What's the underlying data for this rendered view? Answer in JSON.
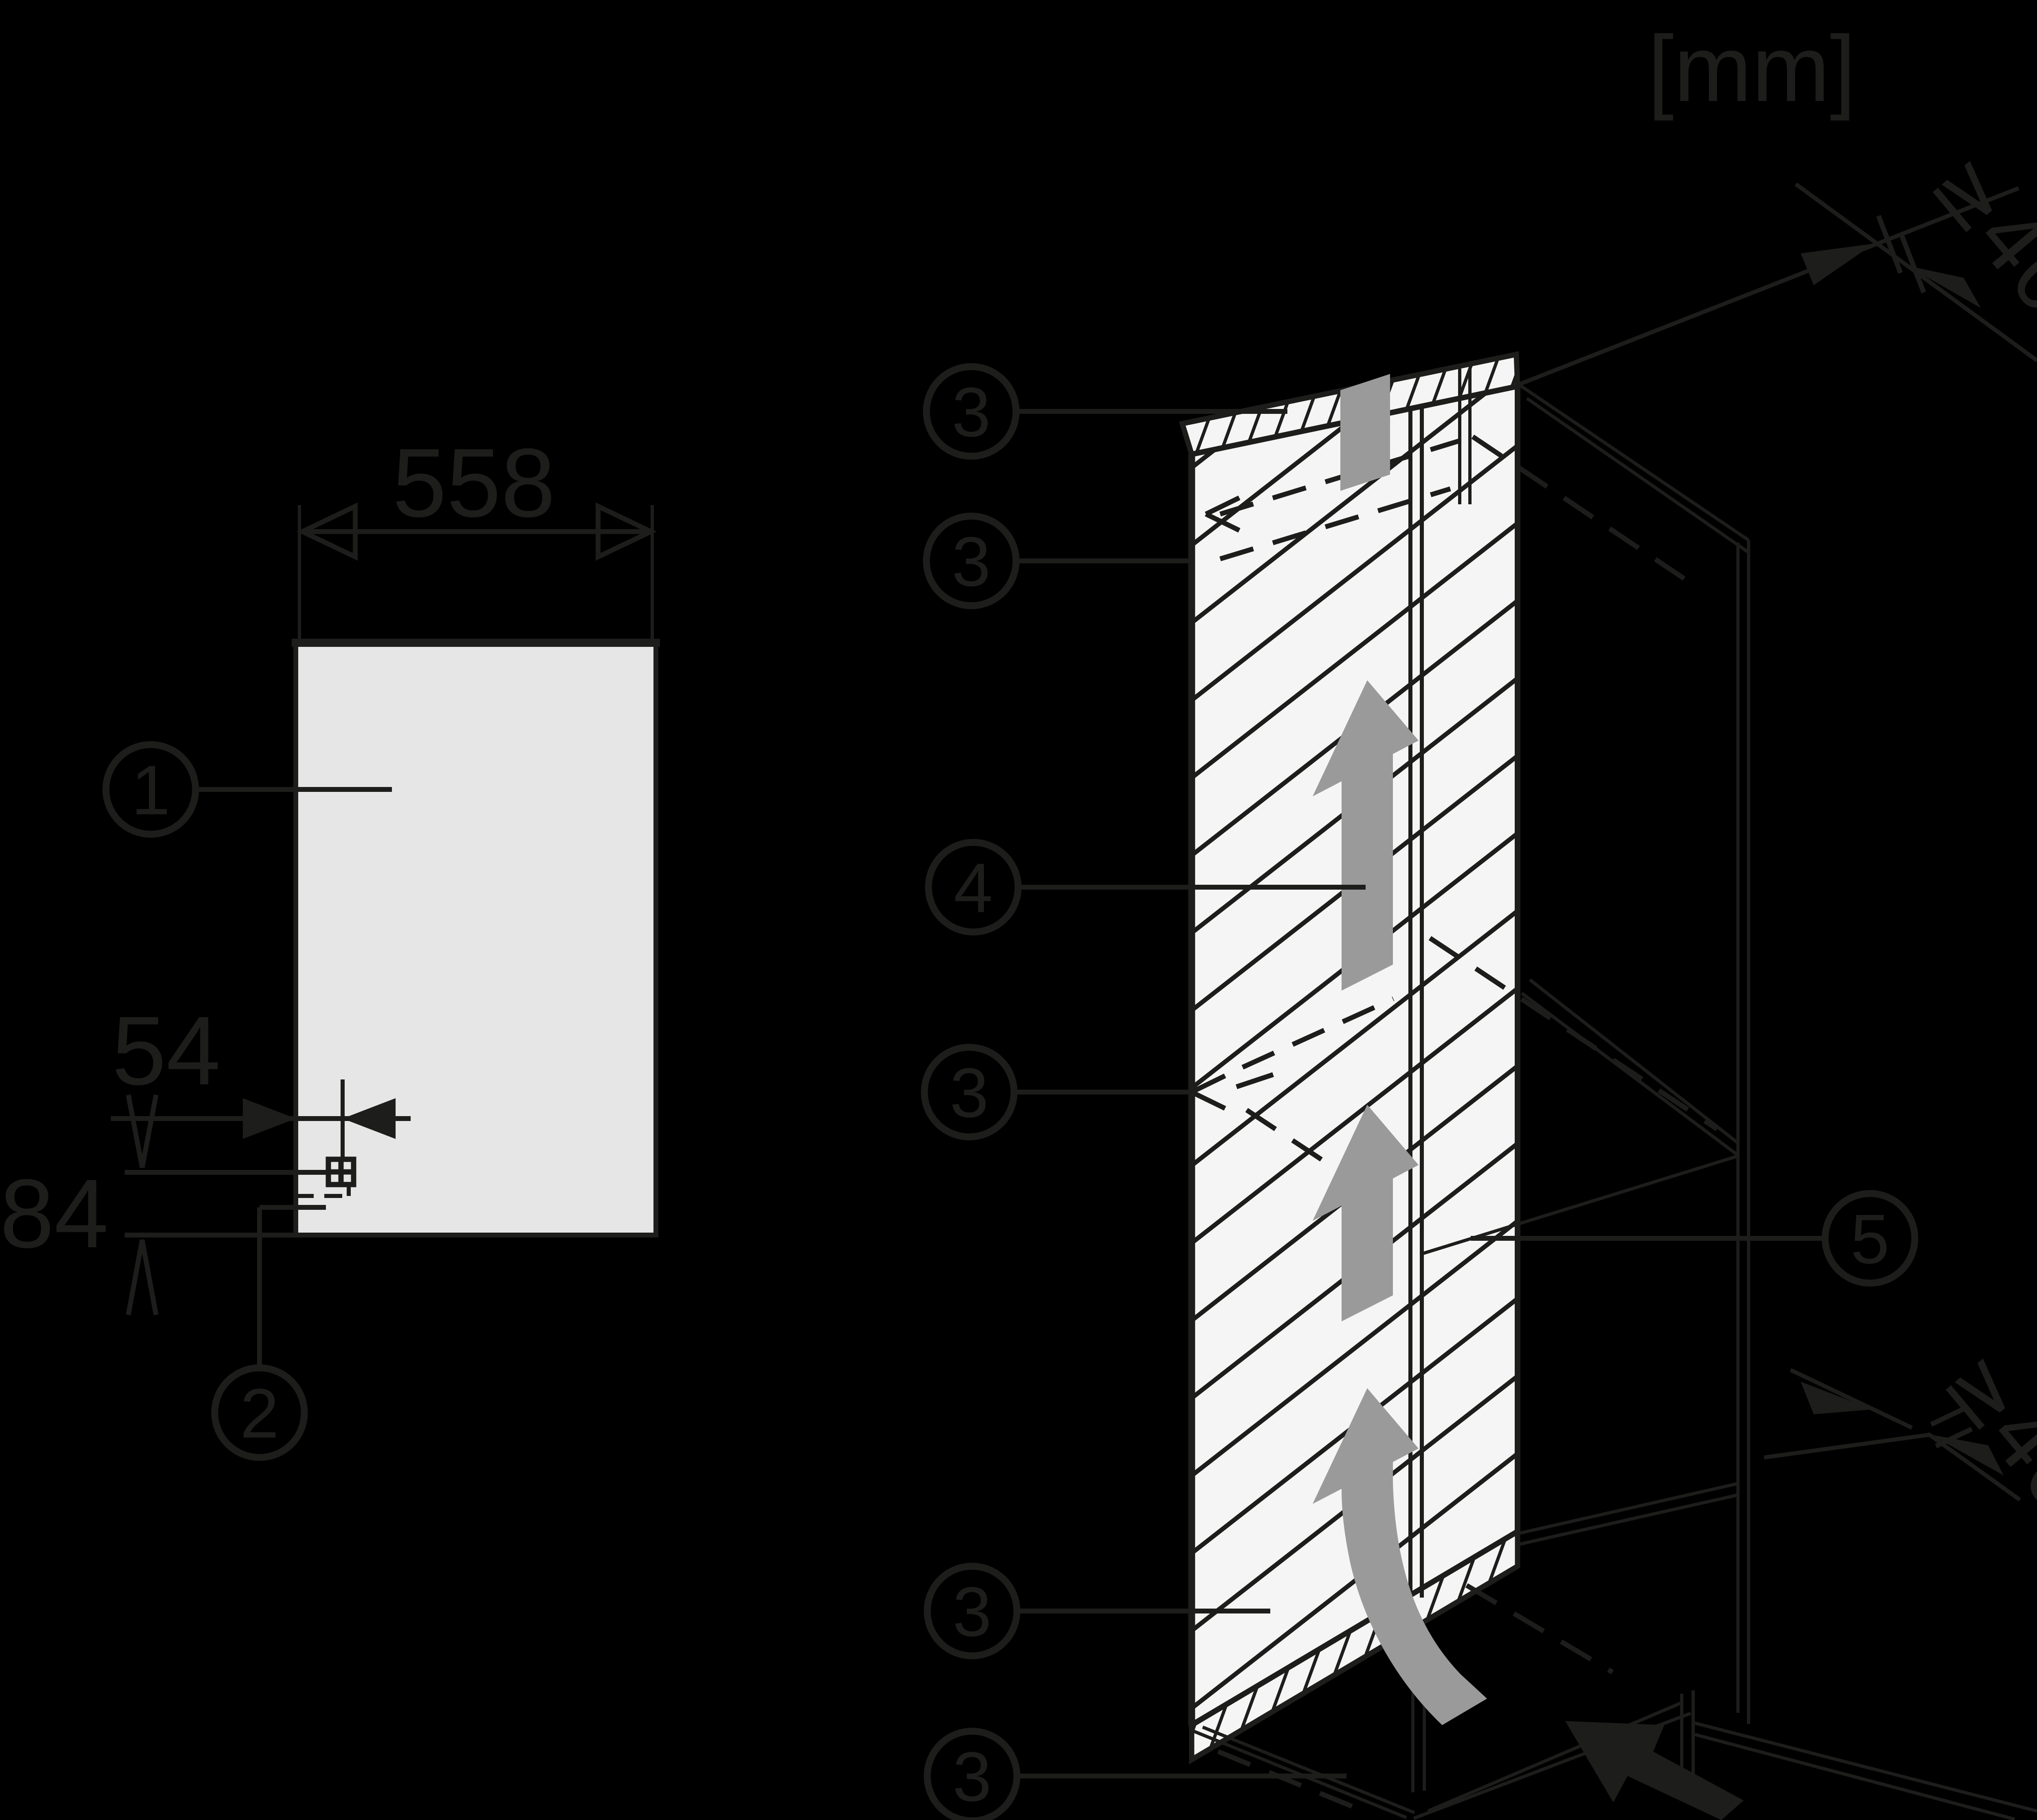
{
  "units_label": "[mm]",
  "colors": {
    "background": "#000000",
    "line": "#1d1d1b",
    "panel_fill": "#f5f5f5",
    "niche_fill": "#e6e6e6",
    "airflow_gray": "#9a9a9a"
  },
  "front_view": {
    "niche_width_mm": "558",
    "socket_offset_x_mm": "54",
    "socket_offset_y_mm": "84",
    "callouts": [
      {
        "id": "niche-opening",
        "label": "1"
      },
      {
        "id": "mains-connection",
        "label": "2"
      }
    ]
  },
  "iso_view": {
    "clearance_top_mm": "≥40",
    "clearance_bottom_mm": "≥40",
    "callouts": [
      {
        "id": "vent-gap-top-a",
        "label": "3"
      },
      {
        "id": "vent-gap-top-b",
        "label": "3"
      },
      {
        "id": "air-duct",
        "label": "4"
      },
      {
        "id": "vent-gap-middle",
        "label": "3"
      },
      {
        "id": "side-wall",
        "label": "5"
      },
      {
        "id": "vent-gap-bottom",
        "label": "3"
      },
      {
        "id": "plinth-vent",
        "label": "3"
      }
    ]
  }
}
